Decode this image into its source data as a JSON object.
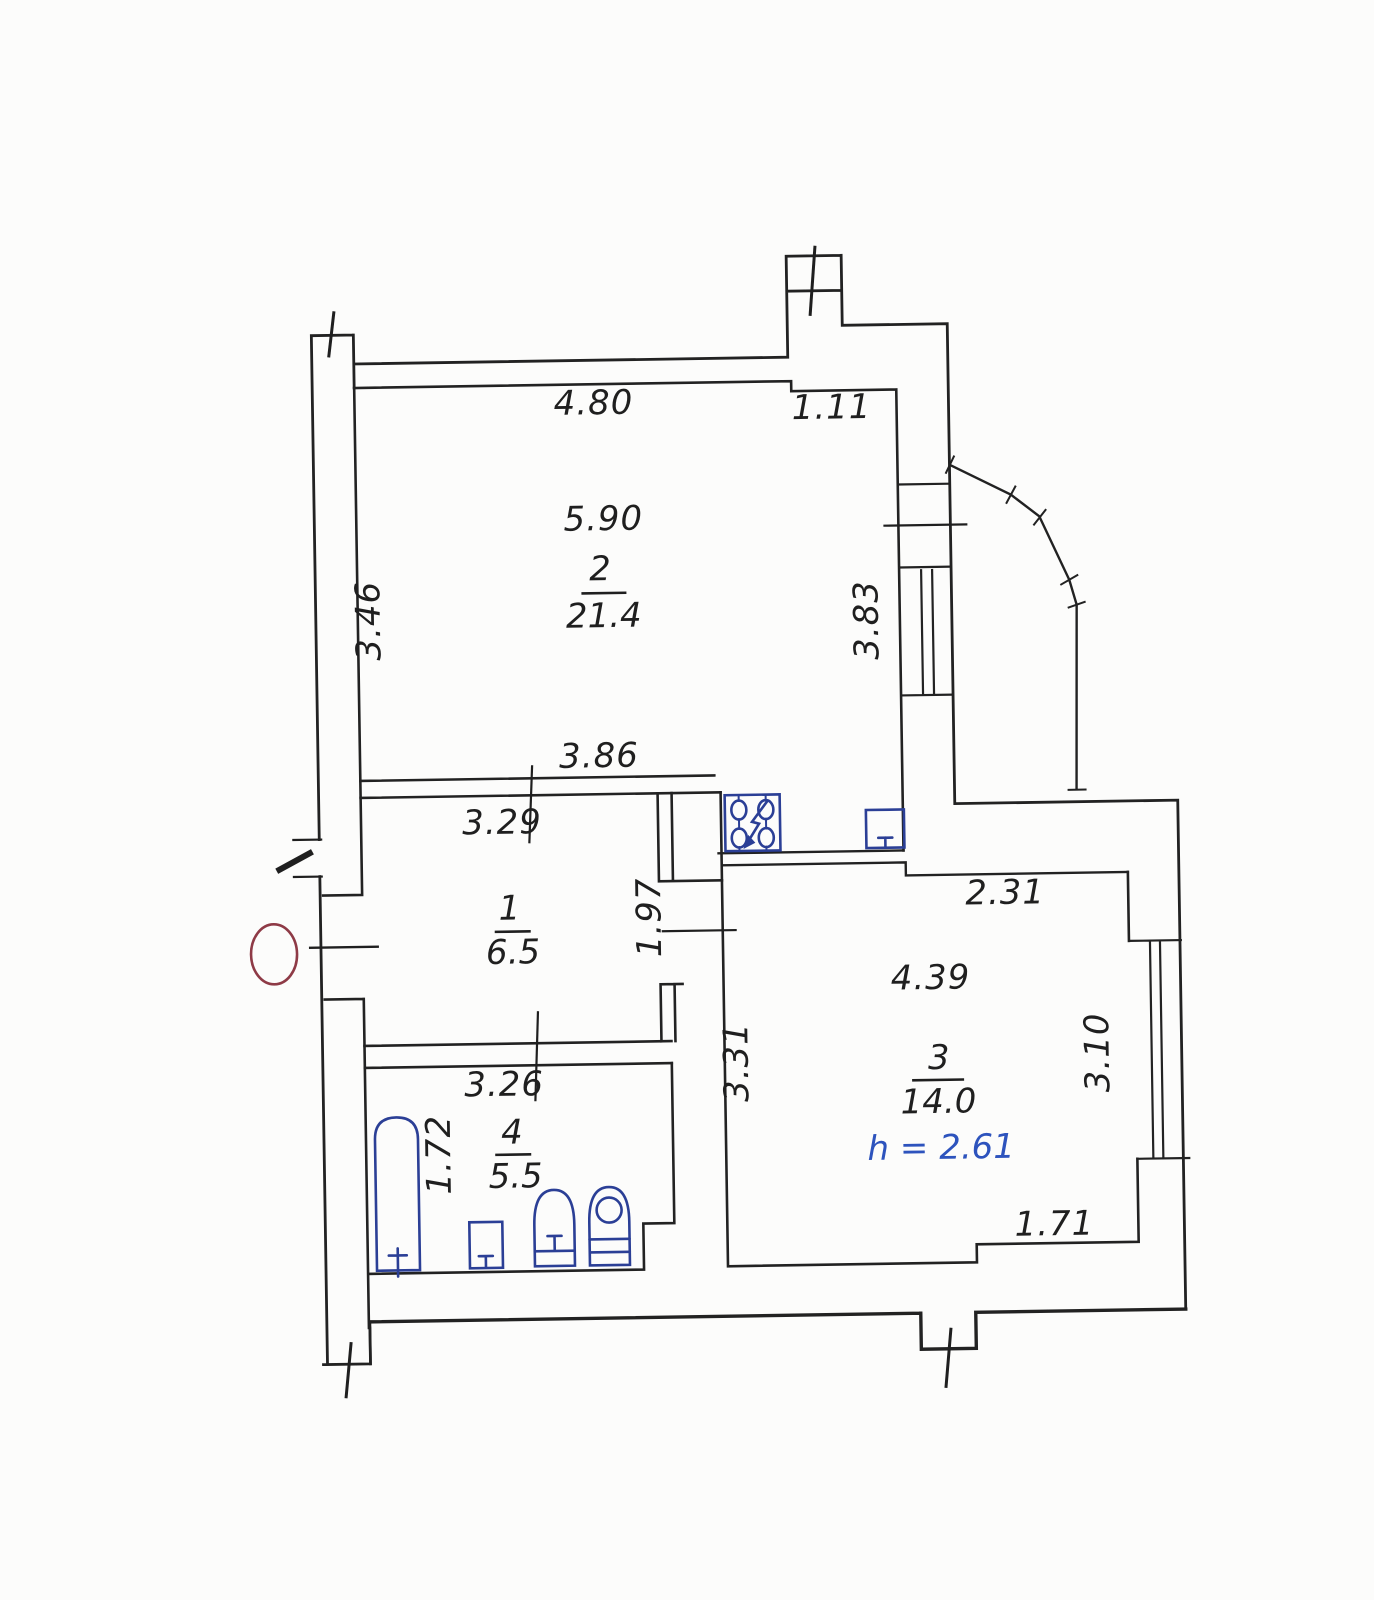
{
  "title": "apartment-floor-plan-scan",
  "colors": {
    "ink": "#222222",
    "fixture_blue": "#2b3f96",
    "height_note_blue": "#2d53bd",
    "stamp_red": "#8e3a46",
    "paper": "#fcfcfb"
  },
  "rooms": [
    {
      "number": "1",
      "area": "6.5"
    },
    {
      "number": "2",
      "area": "21.4"
    },
    {
      "number": "3",
      "area": "14.0"
    },
    {
      "number": "4",
      "area": "5.5"
    }
  ],
  "ceiling_height_note": "h = 2.61",
  "dimensions": {
    "top_run": "4.80",
    "top_niche": "1.11",
    "room2_width": "5.90",
    "room2_left_height": "3.46",
    "room2_right_height": "3.83",
    "room2_bottom_width": "3.86",
    "room1_top_width": "3.29",
    "passage_opening": "1.97",
    "room3_top_width": "2.31",
    "room3_width": "4.39",
    "room3_left_height": "3.31",
    "room3_right_height": "3.10",
    "room3_bottom_width": "1.71",
    "room4_top_width": "3.26",
    "bathtub_length": "1.72"
  }
}
